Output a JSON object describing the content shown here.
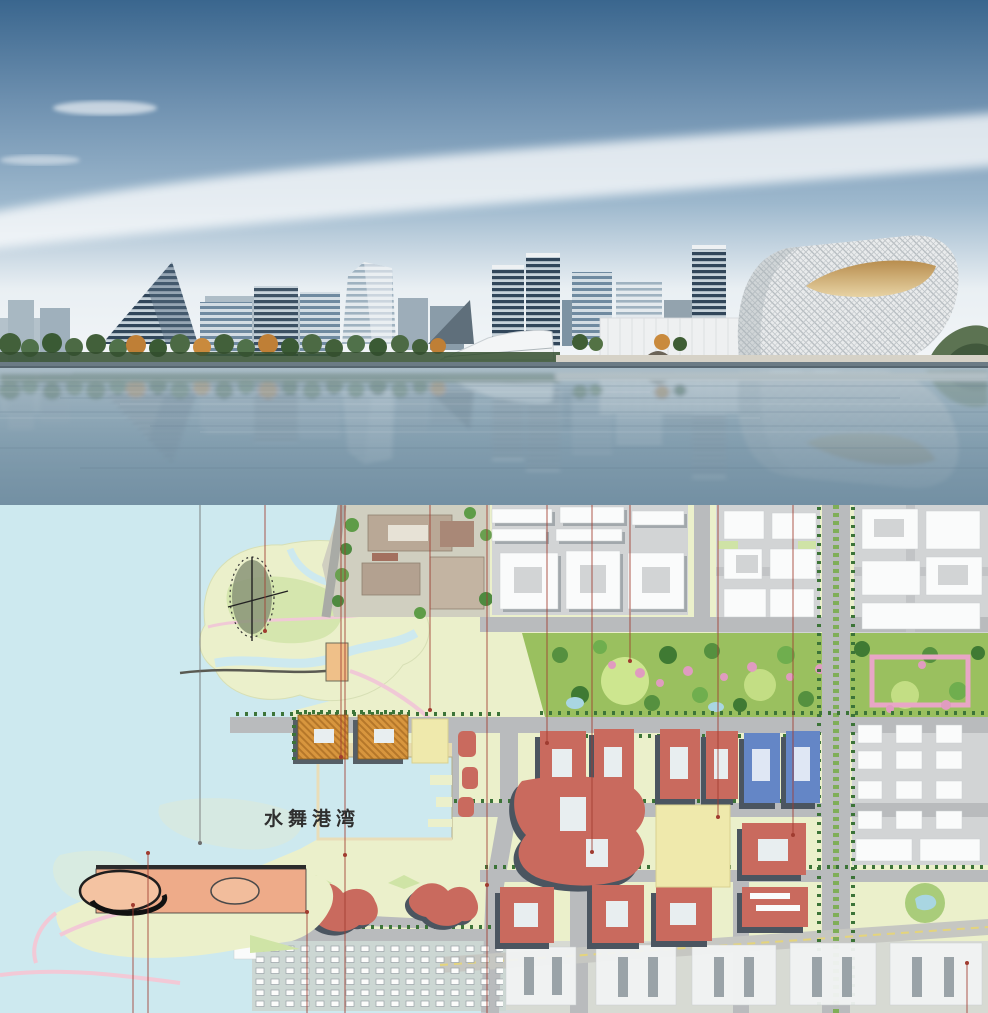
{
  "board": {
    "kind": "architectural masterplan presentation board"
  },
  "palette": {
    "sky_top": "#3a668e",
    "sky_mid": "#9db8cd",
    "sky_horizon": "#f3f6f8",
    "render_water_top": "#a9bcc7",
    "render_water_deep": "#7390a3",
    "map_water": "#cde9ef",
    "map_land": "#ebf0cb",
    "park_green": "#9ac05f",
    "road_gray": "#b9bbbd",
    "existing_building": "#fafbfb",
    "building_shadow": "#9aa1a7",
    "new_building_red": "#c96a5e",
    "new_building_shadow": "#4b5560",
    "office_blue": "#6486c6",
    "hotel_orange": "#d8963e",
    "vacant_yellow": "#efe9ac",
    "blossom_pink": "#e09cc0",
    "tree_green": "#3c7438",
    "leader_red": "#a03c30",
    "leader_gray": "#6f6f6f",
    "arena_plaza": "#eeab89",
    "label_ink": "#2f2f2f"
  },
  "rendering": {
    "scene": "waterfront skyline perspective with water reflection",
    "features": [
      "pyramid-glass-tower",
      "office-towers",
      "white-waterfront-pavilion",
      "museum-box",
      "latticed-dome-hall",
      "tree-lined-promenade"
    ]
  },
  "masterplan": {
    "label": {
      "text": "水舞港湾"
    },
    "leader_lines": [
      {
        "x": 200,
        "y1": 0,
        "y2": 338,
        "color": "gray"
      },
      {
        "x": 265,
        "y1": 0,
        "y2": 126,
        "color": "red"
      },
      {
        "x": 341,
        "y1": 0,
        "y2": 252,
        "color": "red"
      },
      {
        "x": 345,
        "y1": 0,
        "y2": 508,
        "dot": 350,
        "color": "red"
      },
      {
        "x": 430,
        "y1": 0,
        "y2": 205,
        "color": "red"
      },
      {
        "x": 487,
        "y1": 0,
        "y2": 508,
        "dot": 380,
        "color": "red"
      },
      {
        "x": 547,
        "y1": 0,
        "y2": 238,
        "color": "red"
      },
      {
        "x": 592,
        "y1": 0,
        "y2": 347,
        "color": "red"
      },
      {
        "x": 630,
        "y1": 0,
        "y2": 156,
        "color": "red"
      },
      {
        "x": 718,
        "y1": 0,
        "y2": 312,
        "color": "red"
      },
      {
        "x": 793,
        "y1": 0,
        "y2": 330,
        "color": "red"
      },
      {
        "x": 133,
        "y1": 400,
        "y2": 508,
        "color": "red"
      },
      {
        "x": 148,
        "y1": 348,
        "y2": 508,
        "color": "red"
      },
      {
        "x": 307,
        "y1": 407,
        "y2": 508,
        "color": "red"
      },
      {
        "x": 967,
        "y1": 458,
        "y2": 508,
        "color": "red"
      }
    ]
  }
}
